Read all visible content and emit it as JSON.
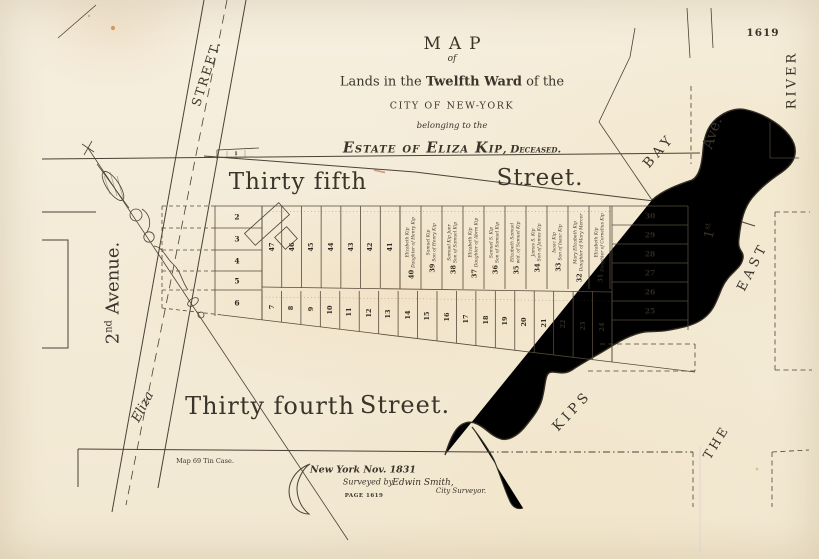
{
  "sheet": {
    "plate_number": "1619",
    "page_ref": "PAGE 1619",
    "map_case_note": "Map 69 Tin Case."
  },
  "title": {
    "word": "MAP",
    "of": "of",
    "line_pre": "Lands in the",
    "line_bold": "Twelfth Ward",
    "line_post": "of the",
    "city": "CITY OF NEW-YORK",
    "belonging": "belonging to the",
    "estate": "Estate of Eliza Kip",
    "estate_suffix": ", Deceased."
  },
  "imprint": {
    "place_date": "New York Nov. 1831",
    "surveyed_by": "Surveyed by",
    "surveyor": "Edwin Smith,",
    "surveyor_title": "City Surveyor."
  },
  "streets": {
    "thirty_fifth": "Thirty fifth",
    "thirty_fifth_suffix": "Street.",
    "thirty_fourth": "Thirty fourth",
    "thirty_fourth_suffix": "Street.",
    "second_avenue_num": "2",
    "second_avenue_sup": "nd",
    "second_avenue_name": " Avenue.",
    "eliza": "Eliza",
    "eliza_suffix": "STREET.",
    "first_avenue_num": "1",
    "first_avenue_sup": "st",
    "first_avenue_name": "Ave."
  },
  "water": {
    "kips": "KIPS",
    "bay": "BAY",
    "the": "THE",
    "east": "EAST",
    "river": "RIVER"
  },
  "lots": {
    "strip_lot": "1",
    "west_column": [
      "2",
      "3",
      "4",
      "5",
      "6"
    ],
    "upper_row_numbers": [
      "47",
      "46",
      "45",
      "44",
      "43",
      "42",
      "41"
    ],
    "name_lots": [
      {
        "number": "40",
        "owner": [
          "Elizabeth Kip",
          "Daughter of Henry Kip"
        ]
      },
      {
        "number": "39",
        "owner": [
          "Samuel Kip",
          "Son of Henry Kip"
        ]
      },
      {
        "number": "38",
        "owner": [
          "Samuel Kip Junr",
          "Son of Samuel Kip"
        ]
      },
      {
        "number": "37",
        "owner": [
          "Elizabeth Kip",
          "Daughter of Abrm Kip"
        ]
      },
      {
        "number": "36",
        "owner": [
          "Samuel S. Kip",
          "Son of Samuel Kip"
        ]
      },
      {
        "number": "35",
        "owner": [
          "Elizabeth Samuel",
          "wid. of Samuel Kip"
        ]
      },
      {
        "number": "34",
        "owner": [
          "James S. Kip",
          "Son of James Kip"
        ]
      },
      {
        "number": "33",
        "owner": [
          "Isaac Kip",
          "Son of Isaac Kip"
        ]
      },
      {
        "number": "32",
        "owner": [
          "Mary Elizabeth Kip",
          "Daughter of Mary Mercer"
        ]
      },
      {
        "number": "31",
        "owner": [
          "Elizabeth Kip",
          "Daughter of Cornelius Kip"
        ]
      }
    ],
    "lower_row_numbers": [
      "7",
      "8",
      "9",
      "10",
      "11",
      "12",
      "13",
      "14",
      "15",
      "16",
      "17",
      "18",
      "19",
      "20",
      "21",
      "22",
      "23",
      "24"
    ],
    "east_stack_numbers": [
      "30",
      "29",
      "28",
      "27",
      "26",
      "25"
    ]
  },
  "colors": {
    "paper": "#f3ebd8",
    "ink": "#3a342b",
    "line": "#4a4136",
    "shore": "#332d23",
    "foxing": "#c27a34"
  }
}
